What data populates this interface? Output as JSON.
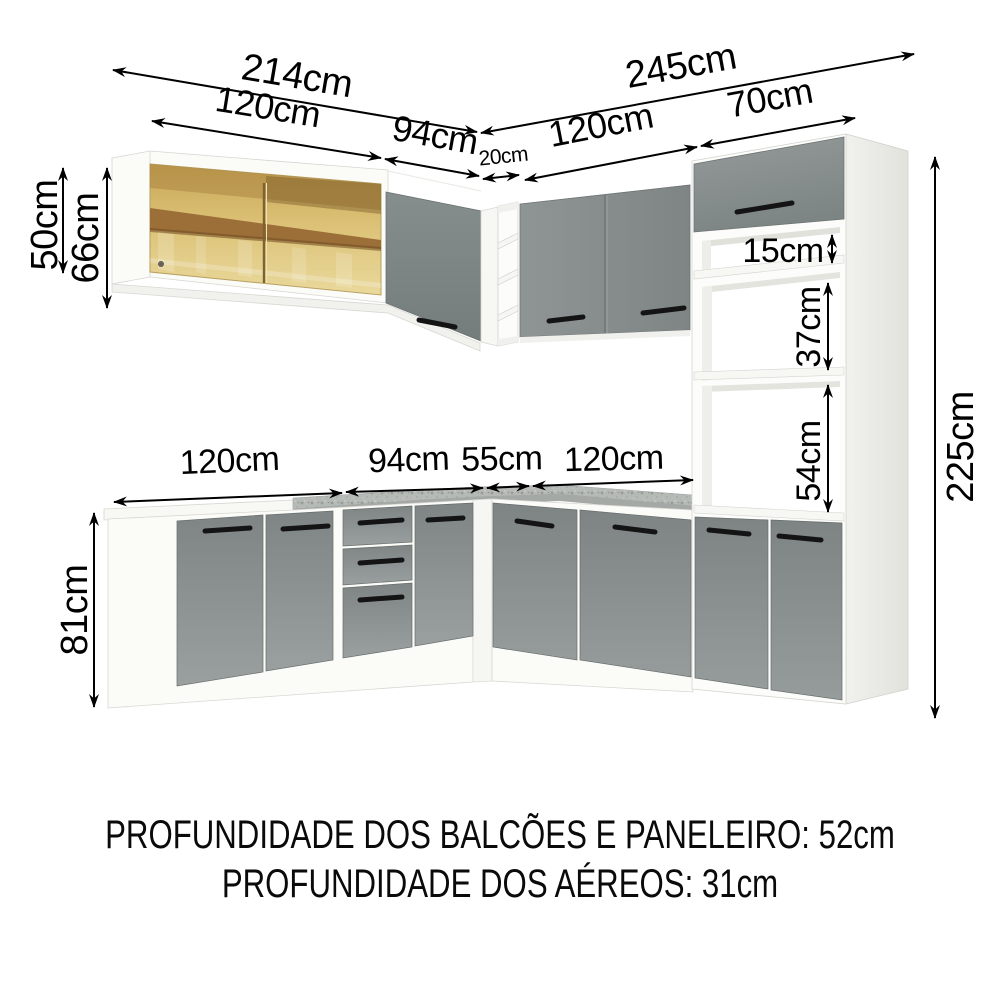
{
  "dims": {
    "top": {
      "total_left": "214cm",
      "seg_left_1": "120cm",
      "seg_left_2": "94cm",
      "seg_corner": "20cm",
      "seg_right_1": "120cm",
      "seg_right_2": "70cm",
      "total_right": "245cm"
    },
    "left": {
      "wall_cabinet_height": "50cm",
      "wall_cabinet_total_height": "66cm",
      "base_cabinet_height": "81cm"
    },
    "middle": {
      "seg_1": "120cm",
      "seg_2": "94cm",
      "seg_3": "55cm",
      "seg_4": "120cm"
    },
    "tower": {
      "gap": "15cm",
      "niche_upper": "37cm",
      "niche_lower": "54cm",
      "total_height": "225cm"
    }
  },
  "footer": {
    "line_1": "PROFUNDIDADE DOS BALCÕES E PANELEIRO: 52cm",
    "line_2": "PROFUNDIDADE DOS AÉREOS: 31cm"
  },
  "colors": {
    "door_gray": "#8b9190",
    "countertop_granite": "#b6bab6",
    "glass_amber": "#ddc379",
    "wood_shelf": "#9c6e38",
    "dimension_text": "#000000",
    "background": "#ffffff"
  }
}
